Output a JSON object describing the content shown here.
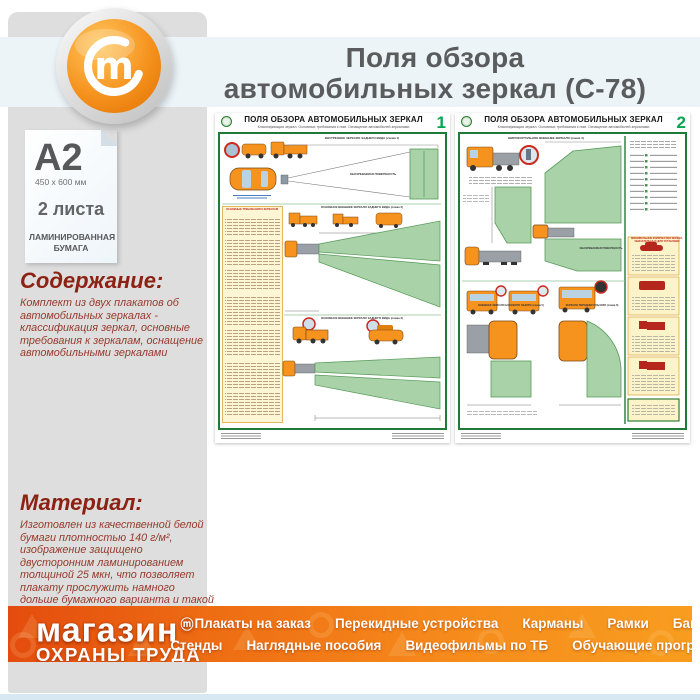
{
  "header": {
    "title_line1": "Поля обзора",
    "title_line2": "автомобильных зеркал (С-78)",
    "logo_letter": "m"
  },
  "sidebar": {
    "format": "A2",
    "size": "450 x 600 мм",
    "sheets": "2 листа",
    "paper_line1": "ЛАМИНИРОВАННАЯ",
    "paper_line2": "БУМАГА",
    "content_heading": "Содержание:",
    "content_text": "Комплект из двух плакатов об автомобильных зеркалах - классификация зеркал, основные требования к зеркалам, оснащение автомобильными зеркалами",
    "material_heading": "Материал:",
    "material_text": "Изготовлен из качественной белой бумаги плотностью 140 г/м², изображение защищено двусторонним ламинированием толщиной 25 мкн, что позволяет плакату прослужить намного дольше бумажного варианта и такой плакат не боится влаги - его смело можно протирать."
  },
  "posters": {
    "shared_title": "ПОЛЯ ОБЗОРА АВТОМОБИЛЬНЫХ ЗЕРКАЛ",
    "shared_subtitle": "Классификация зеркал. Основные требования к ним. Оснащение автомобилей зеркалами",
    "p1": {
      "number": "1",
      "label_scheme1": "ВНУТРЕННЕЕ ЗЕРКАЛО ЗАДНЕГО ВИДА (схема 1)",
      "label_surface": "ОБОЗРЕВАЕМАЯ ПОВЕРХНОСТЬ",
      "label_requirements": "ОСНОВНЫЕ ТРЕБОВАНИЯ К ЗЕРКАЛАМ",
      "label_scheme2": "ОСНОВНОЕ ВНЕШНЕЕ ЗЕРКАЛО ЗАДНЕГО ВИДА (схема 2)",
      "label_scheme3": "ОСНОВНОЕ ВНЕШНЕЕ ЗЕРКАЛО ЗАДНЕГО ВИДА (схема 3)"
    },
    "p2": {
      "number": "2",
      "label_scheme4": "ШИРОКОУГОЛЬНОЕ ВНЕШНЕЕ ЗЕРКАЛО (схема 4)",
      "label_surface": "ОБОЗРЕВАЕМАЯ ПОВЕРХНОСТЬ",
      "label_min_mirrors": "МИНИМАЛЬНОЕ КОЛИЧЕСТВО ЗЕРКАЛ, ОБЯЗАТЕЛЬНЫХ ДЛЯ УСТАНОВКИ",
      "label_scheme5": "ВНЕШНЕЕ ЗЕРКАЛО БОКОВОГО ОБЗОРА (схема 5)",
      "label_scheme6": "ЗЕРКАЛО ПЕРЕДНЕГО ОБЗОРА (схема 6)"
    }
  },
  "footer": {
    "logo_line1": "магазин",
    "logo_tm": "ⓜ",
    "logo_line2": "ОХРАНЫ ТРУДА",
    "menu_row1": [
      "Плакаты на заказ",
      "Перекидные устройства",
      "Карманы",
      "Рамки",
      "Багет"
    ],
    "menu_row2": [
      "Стенды",
      "Наглядные пособия",
      "Видеофильмы по ТБ",
      "Обучающие программы"
    ]
  },
  "colors": {
    "accent_orange": "#f6921e",
    "footer_left": "#e44c0e",
    "footer_right": "#f89d1f",
    "heading_red": "#8d2113",
    "poster_green_border": "#1f7c38",
    "poster_green_fill": "#a9d2a9",
    "number_green": "#00a651",
    "title_gray": "#5a5b5d",
    "band_blue": "#ecf4f8",
    "sidebar_gray": "#dedede"
  }
}
